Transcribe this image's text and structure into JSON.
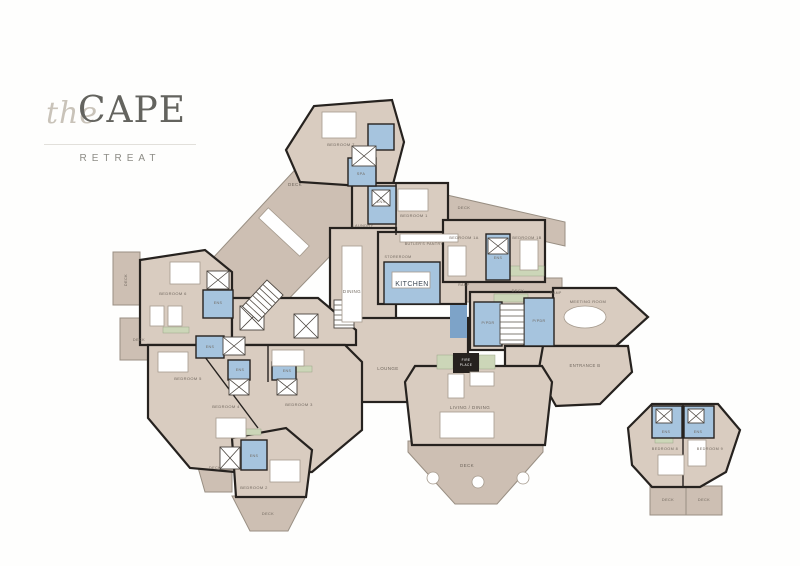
{
  "logo": {
    "script": "the",
    "name": "CAPE",
    "subtitle": "RETREAT"
  },
  "colors": {
    "room": "#d9ccc0",
    "deck": "#cdbfb3",
    "deckline": "#998f83",
    "wet": "#a6c4de",
    "wetdark": "#7da3c8",
    "green": "#ccd6b8",
    "wall": "#26221f",
    "label": "#6f665d"
  },
  "floorplan": {
    "rooms": [
      {
        "id": "deck-diagonal",
        "label": "DECK",
        "x": 295,
        "y": 186,
        "size": 4.5
      },
      {
        "id": "bedroom-7",
        "label": "BEDROOM 7",
        "x": 341,
        "y": 146,
        "size": 4
      },
      {
        "id": "spa",
        "label": "SPA",
        "x": 361,
        "y": 175,
        "size": 3.8
      },
      {
        "id": "ens-bedroom-1",
        "label": "ENS",
        "x": 381,
        "y": 203,
        "size": 3.6
      },
      {
        "id": "laundry",
        "label": "LAUNDRY",
        "x": 363,
        "y": 227,
        "size": 3.8
      },
      {
        "id": "bedroom-1",
        "label": "BEDROOM 1",
        "x": 414,
        "y": 217,
        "size": 4
      },
      {
        "id": "butlers-pantry",
        "label": "BUTLER'S PANTRY",
        "x": 424,
        "y": 245,
        "size": 3.6
      },
      {
        "id": "storeroom",
        "label": "STOREROOM",
        "x": 398,
        "y": 258,
        "size": 3.6
      },
      {
        "id": "kitchen",
        "label": "KITCHEN",
        "x": 412,
        "y": 286,
        "size": 7,
        "color": "#3f4a56"
      },
      {
        "id": "dining",
        "label": "DINING",
        "x": 352,
        "y": 293,
        "size": 4.5
      },
      {
        "id": "deck-north",
        "label": "DECK",
        "x": 464,
        "y": 209,
        "size": 4
      },
      {
        "id": "bedroom-1a",
        "label": "BEDROOM 1A",
        "x": 464,
        "y": 239,
        "size": 3.8
      },
      {
        "id": "ens-bedroom-1ab",
        "label": "ENS",
        "x": 498,
        "y": 259,
        "size": 3.6
      },
      {
        "id": "bedroom-1b",
        "label": "BEDROOM 1B",
        "x": 527,
        "y": 239,
        "size": 3.8
      },
      {
        "id": "ramp-west",
        "label": "RAMP",
        "x": 464,
        "y": 286,
        "size": 3.4
      },
      {
        "id": "deck-east",
        "label": "DECK",
        "x": 518,
        "y": 292,
        "size": 4
      },
      {
        "id": "ramp-east",
        "label": "RAMP",
        "x": 556,
        "y": 294,
        "size": 3.4
      },
      {
        "id": "meeting-room",
        "label": "MEETING ROOM",
        "x": 588,
        "y": 303,
        "size": 4
      },
      {
        "id": "entrance-b",
        "label": "ENTRANCE B",
        "x": 585,
        "y": 367,
        "size": 4.2
      },
      {
        "id": "living-dining",
        "label": "LIVING / DINING",
        "x": 470,
        "y": 409,
        "size": 4.5
      },
      {
        "id": "deck-living",
        "label": "DECK",
        "x": 467,
        "y": 467,
        "size": 4.5
      },
      {
        "id": "fireplace-line-1",
        "label": "FIRE",
        "x": 466,
        "y": 361,
        "size": 3.2,
        "color": "#ffffff"
      },
      {
        "id": "fireplace-line-2",
        "label": "PLACE",
        "x": 466,
        "y": 366,
        "size": 3.2,
        "color": "#ffffff"
      },
      {
        "id": "pdr-west",
        "label": "P/PDR",
        "x": 488,
        "y": 324,
        "size": 3.6
      },
      {
        "id": "pdr-east",
        "label": "P/PDR",
        "x": 539,
        "y": 322,
        "size": 3.6
      },
      {
        "id": "lounge",
        "label": "LOUNGE",
        "x": 388,
        "y": 370,
        "size": 4.5
      },
      {
        "id": "bedroom-6",
        "label": "BEDROOM 6",
        "x": 173,
        "y": 295,
        "size": 4
      },
      {
        "id": "ens-bedroom-6",
        "label": "ENS",
        "x": 218,
        "y": 304,
        "size": 3.6
      },
      {
        "id": "deck-west-upper",
        "label": "DECK",
        "x": 127,
        "y": 280,
        "size": 3.8,
        "rot": -90
      },
      {
        "id": "deck-west-lower",
        "label": "DECK",
        "x": 139,
        "y": 341,
        "size": 3.8
      },
      {
        "id": "ens-bedroom-5",
        "label": "ENS",
        "x": 210,
        "y": 348,
        "size": 3.6
      },
      {
        "id": "bedroom-5",
        "label": "BEDROOM 5",
        "x": 188,
        "y": 380,
        "size": 4
      },
      {
        "id": "ens-bedroom-4",
        "label": "ENS",
        "x": 240,
        "y": 371,
        "size": 3.6
      },
      {
        "id": "bedroom-4",
        "label": "BEDROOM 4",
        "x": 226,
        "y": 408,
        "size": 4
      },
      {
        "id": "ens-bedroom-3",
        "label": "ENS",
        "x": 287,
        "y": 372,
        "size": 3.6
      },
      {
        "id": "bedroom-3",
        "label": "BEDROOM 3",
        "x": 299,
        "y": 406,
        "size": 4
      },
      {
        "id": "deck-cluster",
        "label": "DECK",
        "x": 215,
        "y": 469,
        "size": 3.8
      },
      {
        "id": "ens-bedroom-2",
        "label": "ENS",
        "x": 254,
        "y": 457,
        "size": 3.6
      },
      {
        "id": "bedroom-2",
        "label": "BEDROOM 2",
        "x": 254,
        "y": 489,
        "size": 4
      },
      {
        "id": "deck-bedroom-2",
        "label": "DECK",
        "x": 268,
        "y": 515,
        "size": 3.8
      },
      {
        "id": "ens-bedroom-8",
        "label": "ENS",
        "x": 666,
        "y": 433,
        "size": 3.6
      },
      {
        "id": "ens-bedroom-9",
        "label": "ENS",
        "x": 698,
        "y": 433,
        "size": 3.6
      },
      {
        "id": "bedroom-8",
        "label": "BEDROOM 8",
        "x": 665,
        "y": 450,
        "size": 3.8
      },
      {
        "id": "bedroom-9",
        "label": "BEDROOM 9",
        "x": 710,
        "y": 450,
        "size": 3.8
      },
      {
        "id": "deck-bedroom-8",
        "label": "DECK",
        "x": 668,
        "y": 501,
        "size": 3.8
      },
      {
        "id": "deck-bedroom-9",
        "label": "DECK",
        "x": 704,
        "y": 501,
        "size": 3.8
      }
    ]
  }
}
